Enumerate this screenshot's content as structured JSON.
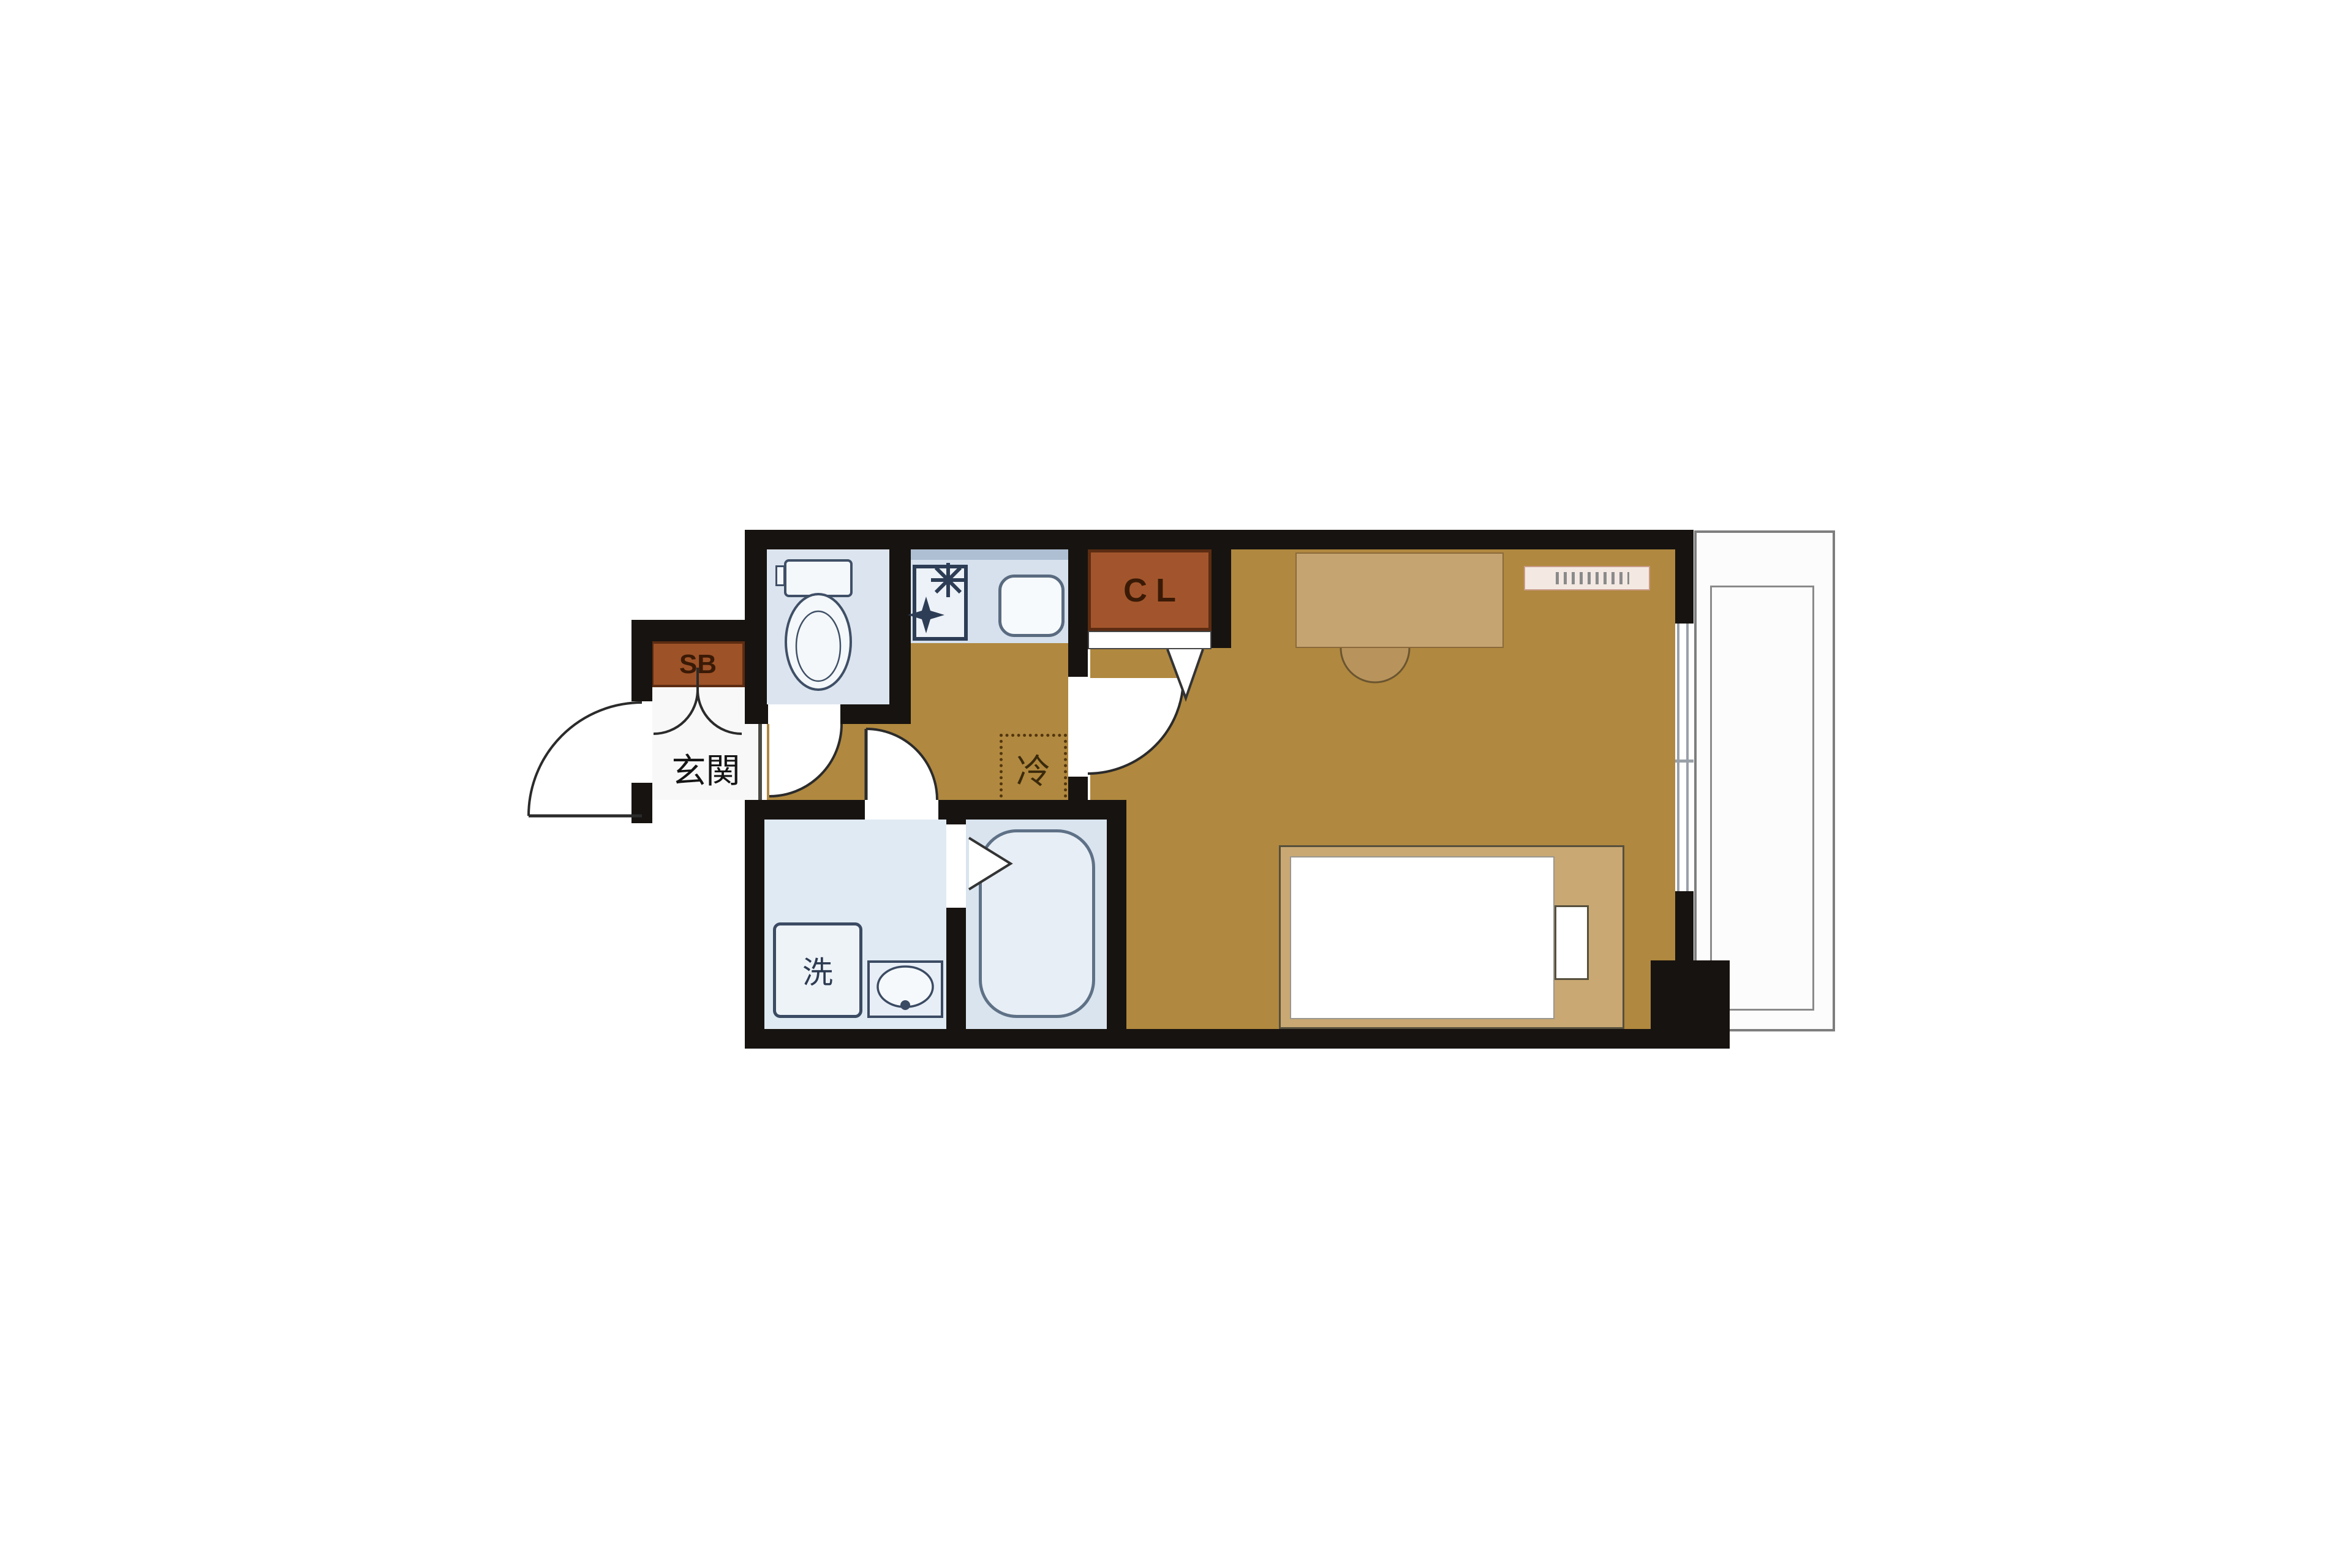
{
  "page": {
    "kind": "japanese-apartment-floor-plan",
    "background": "#ffffff"
  },
  "labels": {
    "shoe_box": "SB",
    "closet": "CL",
    "entrance": "玄関",
    "refrigerator": "冷",
    "washing_machine": "洗"
  },
  "colors": {
    "wall": "#171310",
    "floor_wood": "#b0883f",
    "furniture_wood": "#c6a472",
    "bed_frame": "#c9a873",
    "storage_brown": "#a2552c",
    "storage_border": "#5c2c12",
    "storage_letter": "#3a1a06",
    "wet_room_blue": "#dce6ef",
    "kitchen_blue": "#d6e1ed",
    "fixture_outline": "#3b4b63",
    "balcony_line": "#7e7e7e"
  },
  "fixtures": [
    "entrance-door-arc",
    "shoe-box",
    "toilet",
    "kitchen-stove",
    "kitchen-sink",
    "closet-folding-door",
    "refrigerator-space",
    "washing-machine",
    "washbasin",
    "bathtub",
    "bathroom-folding-door",
    "desk",
    "chair",
    "wall-shelf",
    "bed",
    "pillow",
    "window",
    "balcony"
  ]
}
